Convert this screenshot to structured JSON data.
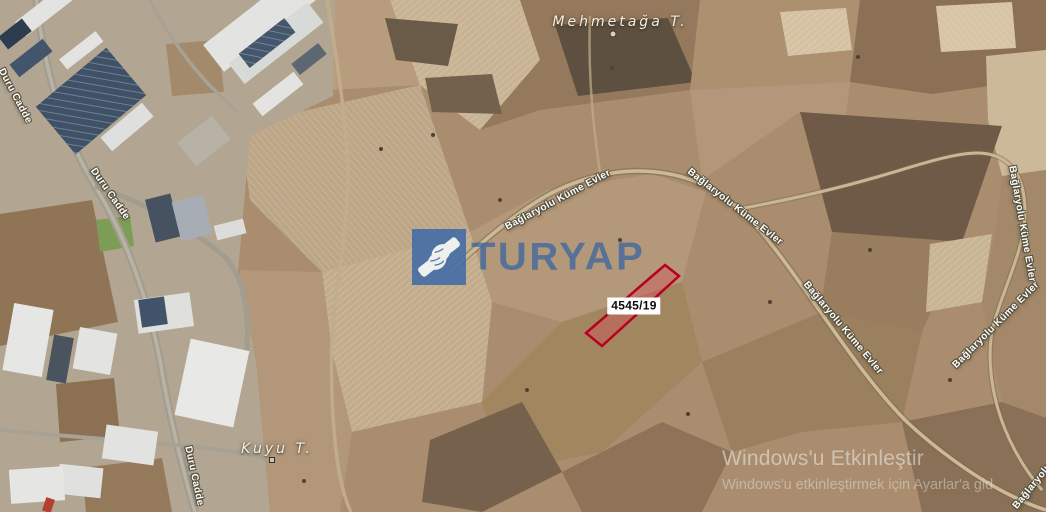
{
  "map": {
    "place_labels": [
      {
        "name": "Mehmetağa T.",
        "marker": "circle-marker"
      },
      {
        "name": "Kuyu T.",
        "marker": "square-marker"
      }
    ],
    "road_labels": [
      {
        "text": "Bağlaryolu Küme Evler"
      },
      {
        "text": "Bağlaryolu Küme Evler"
      },
      {
        "text": "Bağlaryolu Küme Evler"
      },
      {
        "text": "Bağlaryolu Küme Evler"
      },
      {
        "text": "Bağlaryolu Küme Evler"
      },
      {
        "text": "Bağlaryolu Küme Evler"
      },
      {
        "text": "Duru Cadde"
      },
      {
        "text": "Duru Cadde"
      },
      {
        "text": "Duru Cadde"
      }
    ],
    "parcel": {
      "id": "4545/19",
      "outline_color": "#b8001f",
      "fill_color": "rgba(222,70,85,0.35)"
    }
  },
  "watermark": {
    "brand": "TURYAP",
    "logo_icon": "handshake-icon",
    "logo_color": "#3c68a8"
  },
  "activation": {
    "line1": "Windows'u Etkinleştir",
    "line2": "Windows'u etkinleştirmek için Ayarlar'a gid"
  }
}
